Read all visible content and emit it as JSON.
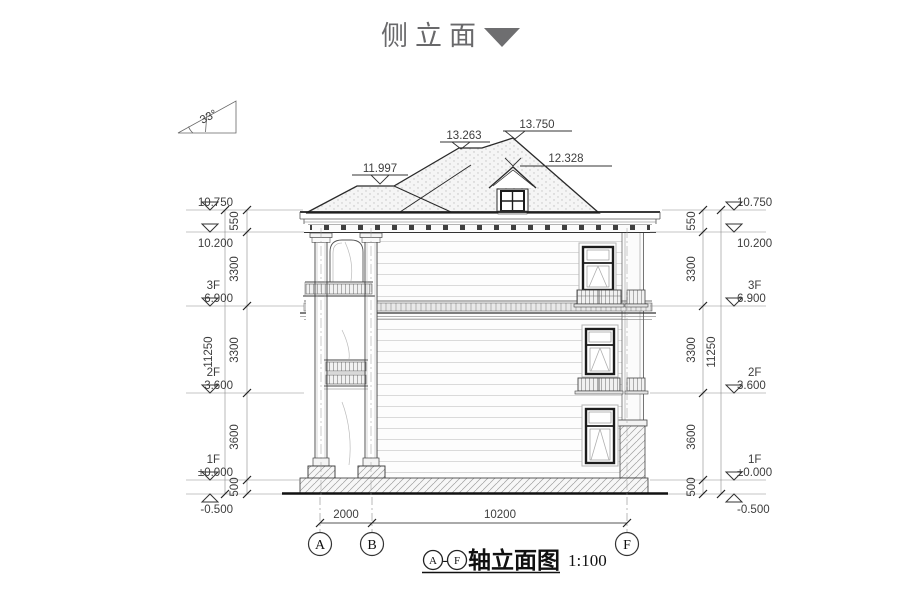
{
  "title": {
    "text": "侧立面",
    "collapse_icon": "triangle-down"
  },
  "slope_indicator": {
    "angle": "33°"
  },
  "roof": {
    "ridge_left": "11.997",
    "step": "13.263",
    "apex": "13.750",
    "dormer_ridge": "12.328"
  },
  "levels": {
    "left": [
      {
        "floor": "",
        "value": "10.750"
      },
      {
        "floor": "",
        "value": "10.200"
      },
      {
        "floor": "3F",
        "value": "6.900"
      },
      {
        "floor": "2F",
        "value": "3.600"
      },
      {
        "floor": "1F",
        "value": "±0.000"
      },
      {
        "floor": "",
        "value": "-0.500"
      }
    ],
    "right": [
      {
        "floor": "",
        "value": "10.750"
      },
      {
        "floor": "",
        "value": "10.200"
      },
      {
        "floor": "3F",
        "value": "6.900"
      },
      {
        "floor": "2F",
        "value": "3.600"
      },
      {
        "floor": "1F",
        "value": "±0.000"
      },
      {
        "floor": "",
        "value": "-0.500"
      }
    ]
  },
  "dims": {
    "left_segments": [
      "550",
      "3300",
      "3300",
      "3600",
      "500"
    ],
    "left_total": "11250",
    "right_segments": [
      "550",
      "3300",
      "3300",
      "3600",
      "500"
    ],
    "right_total": "11250",
    "bottom": {
      "a_b": "2000",
      "b_f": "10200"
    }
  },
  "axes": {
    "a": "A",
    "b": "B",
    "f": "F"
  },
  "caption": {
    "from": "A",
    "sep": "-",
    "to": "F",
    "title": "轴立面图",
    "scale": "1:100"
  }
}
